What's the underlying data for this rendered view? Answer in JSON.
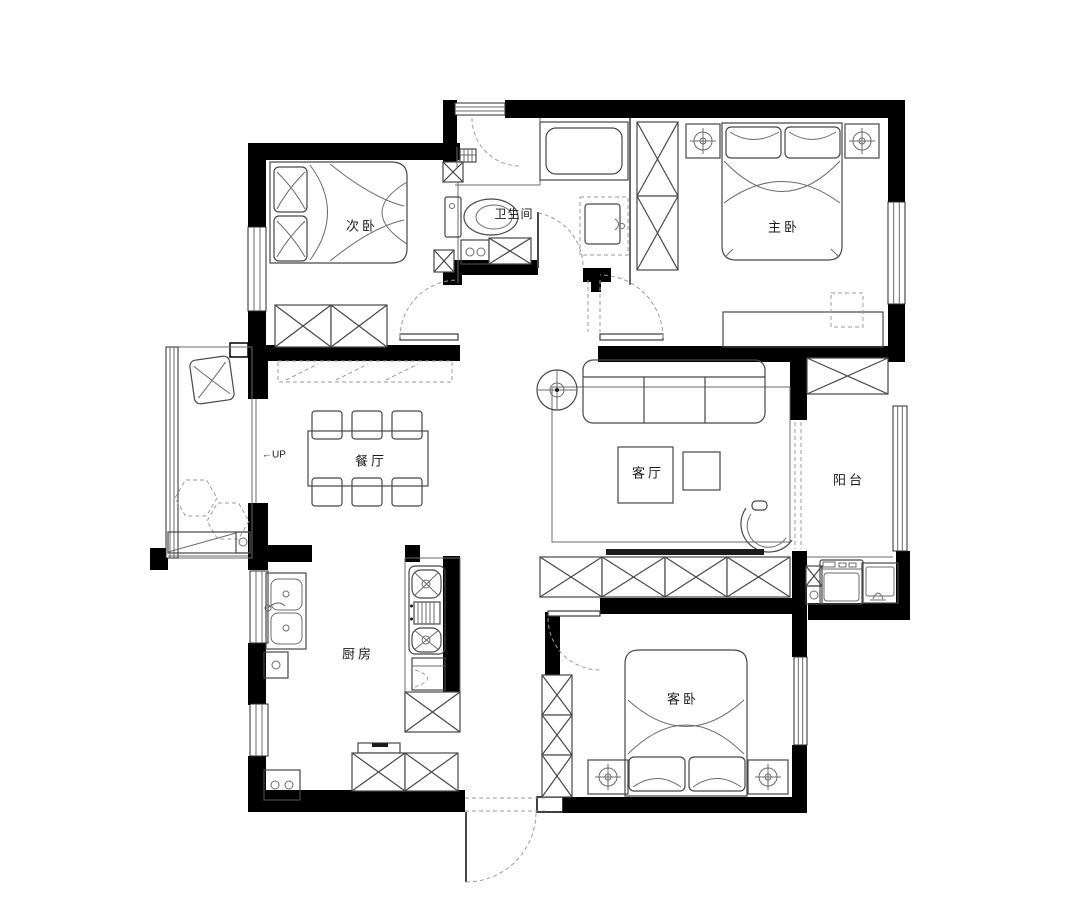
{
  "diagram": {
    "type": "apartment-floor-plan"
  },
  "rooms": [
    {
      "id": "secondary-bedroom",
      "label": "次卧"
    },
    {
      "id": "bathroom",
      "label": "卫生间"
    },
    {
      "id": "master-bedroom",
      "label": "主卧"
    },
    {
      "id": "dining-room",
      "label": "餐厅"
    },
    {
      "id": "living-room",
      "label": "客厅"
    },
    {
      "id": "balcony",
      "label": "阳台"
    },
    {
      "id": "kitchen",
      "label": "厨房"
    },
    {
      "id": "guest-bedroom",
      "label": "客卧"
    }
  ],
  "annotations": [
    {
      "id": "stairs-up",
      "label": "←UP"
    }
  ],
  "colors": {
    "wall": "#000000",
    "furniture_line": "#474747",
    "dashed_line": "#9b9b9b",
    "background": "#ffffff",
    "text": "#1a1a1a"
  }
}
